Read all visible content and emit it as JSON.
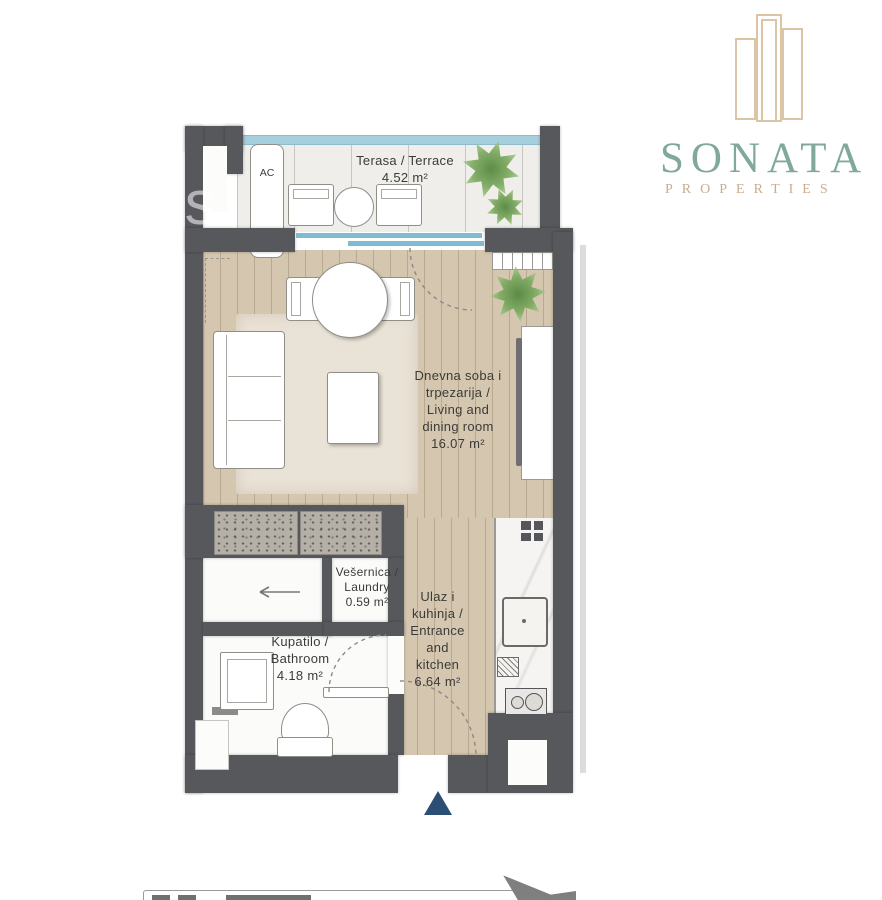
{
  "brand": {
    "name": "SONATA",
    "tagline": "PROPERTIES",
    "colors": {
      "name": "#80a99b",
      "tagline": "#c8ad8d",
      "building_icon": "#dcc5a6"
    }
  },
  "watermark": {
    "text": "rs"
  },
  "plan": {
    "ac_label": "AC",
    "rooms": {
      "terrace": {
        "name": "Terasa / Terrace",
        "area": "4.52 m²"
      },
      "living": {
        "name": "Dnevna soba i\ntrpezarija /\nLiving and\ndining room",
        "area": "16.07 m²"
      },
      "laundry": {
        "name": "Vešernica /\nLaundry",
        "area": "0.59 m²"
      },
      "entrance": {
        "name": "Ulaz i\nkuhinja /\nEntrance\nand\nkitchen",
        "area": "6.64 m²"
      },
      "bathroom": {
        "name": "Kupatilo /\nBathroom",
        "area": "4.18 m²"
      }
    },
    "colors": {
      "wall": "#57585c",
      "wood_floor": "#d5c6b0",
      "terrace_floor": "#efeeea",
      "glass_blue": "#7fbcd2",
      "entrance_marker": "#2b4e75"
    },
    "icons": {
      "entrance_marker": "navy triangle pointing up at entry door",
      "north_arrow": "gray compass arrow (cropped, bottom right)",
      "scale_bar": "segmented scale bar (cropped, bottom left)",
      "plants": "green foliage starbursts",
      "shower_arrow": "left arrow indicating sliding door"
    }
  }
}
